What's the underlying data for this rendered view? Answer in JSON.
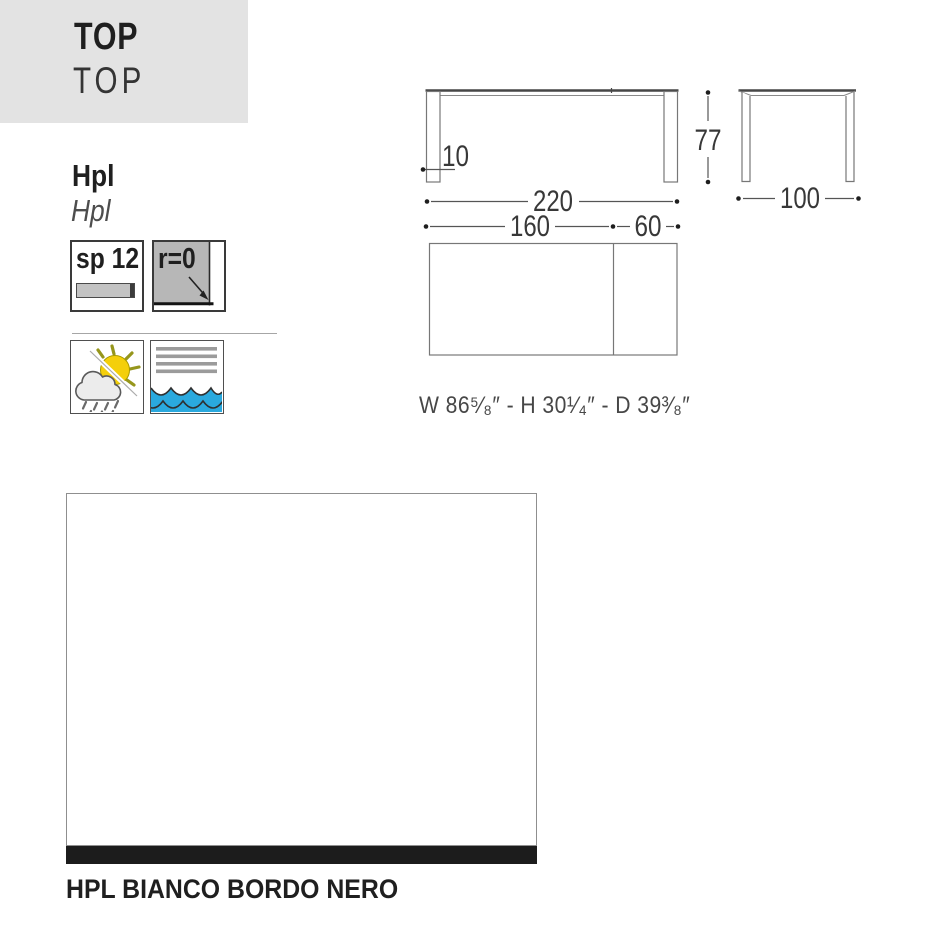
{
  "header": {
    "title": "TOP",
    "subtitle": "TOP"
  },
  "material": {
    "name": "Hpl",
    "name_italic": "Hpl"
  },
  "specs": {
    "thickness_label": "sp 12",
    "edge_radius_label": "r=0"
  },
  "feature_icons": {
    "weather": "all-weather-outdoor-icon",
    "water": "water-resistant-icon"
  },
  "drawing": {
    "front_width_cm": "220",
    "front_height_cm": "77",
    "leg_thickness_cm": "10",
    "side_depth_cm": "100",
    "top_fixed_cm": "160",
    "top_extension_cm": "60",
    "imperial_dims": "W 86⁵⁄₈″ - H 30¹⁄₄″ - D 39³⁄₈″"
  },
  "swatch": {
    "label": "HPL BIANCO BORDO NERO"
  },
  "colors": {
    "header_bg": "#e3e3e3",
    "wave_blue": "#2aa9de",
    "sun_yellow": "#f4cf0b",
    "icon_gray": "#b7b7b7",
    "swatch_edge_black": "#1c1c1c",
    "line_gray": "#777777"
  }
}
